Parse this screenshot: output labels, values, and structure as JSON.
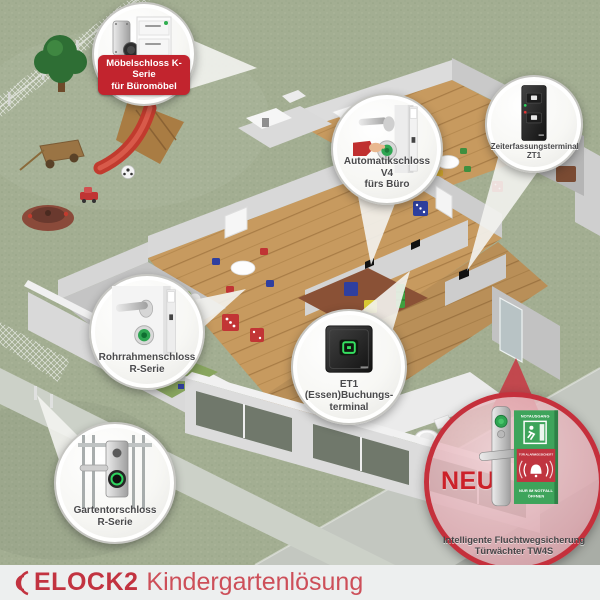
{
  "footer": {
    "brand": "ELOCK2",
    "product_line": "Kindergartenlösung"
  },
  "colors": {
    "brand_red": "#c23340",
    "badge_red": "#c2242e",
    "neu_red": "#cc2129",
    "sign_green": "#3ea45b",
    "alarm_red": "#c03540",
    "led_green": "#2fa552",
    "led_red": "#e03535"
  },
  "callouts": [
    {
      "id": "moebelschloss-k-serie",
      "line1": "Möbelschloss K-Serie",
      "line2": "für Büromöbel"
    },
    {
      "id": "automatikschloss-v4",
      "line1": "Automatikschloss V4",
      "line2": "fürs Büro"
    },
    {
      "id": "zeiterfassungsterminal-zt1",
      "line1": "Zeiterfassungsterminal",
      "line2": "ZT1"
    },
    {
      "id": "rohrrahmenschloss-r-serie",
      "line1": "Rohrrahmenschloss",
      "line2": "R-Serie"
    },
    {
      "id": "et1-buchungsterminal",
      "line1": "ET1",
      "line2": "(Essen)Buchungs-",
      "line3": "terminal"
    },
    {
      "id": "gartentorschloss-r-serie",
      "line1": "Gartentorschloss",
      "line2": "R-Serie"
    },
    {
      "id": "tuerwaechter-tw4s",
      "badge": "NEU",
      "line1": "Intelligente Fluchtwegsicherung",
      "line2": "Türwächter TW4S",
      "sign": {
        "header": "NOTAUSGANG",
        "alarm": "TÜR ALARMGESICHERT",
        "note1": "NUR IM NOTFALL",
        "note2": "ÖFFNEN"
      }
    }
  ]
}
